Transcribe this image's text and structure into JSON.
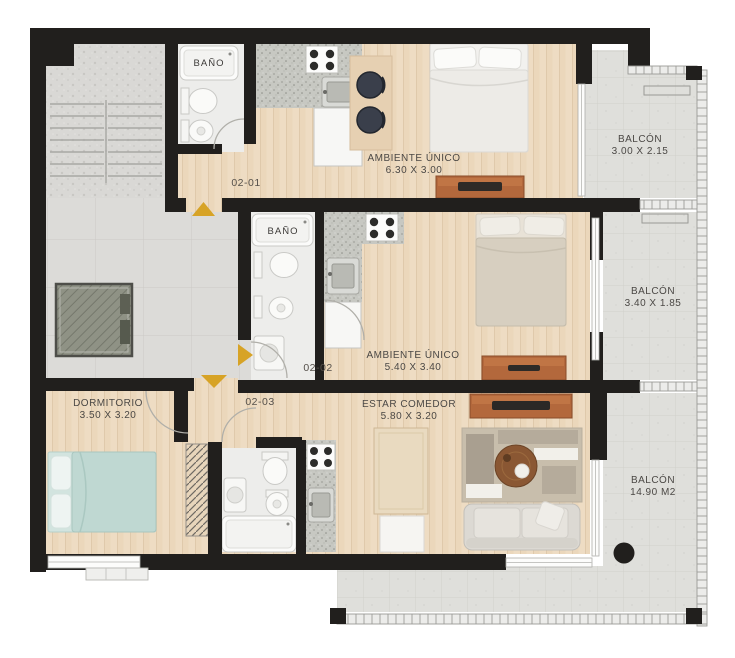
{
  "plan": {
    "type": "apartment-floor-plan",
    "units": {
      "unit_1": {
        "code": "02-01"
      },
      "unit_2": {
        "code": "02-02"
      },
      "unit_3": {
        "code": "02-03"
      }
    },
    "rooms": {
      "bano_1": {
        "name": "BAÑO"
      },
      "bano_2": {
        "name": "BAÑO"
      },
      "ambiente_unico_1": {
        "name": "AMBIENTE ÚNICO",
        "dims": "6.30 X 3.00"
      },
      "ambiente_unico_2": {
        "name": "AMBIENTE ÚNICO",
        "dims": "5.40 X 3.40"
      },
      "dormitorio": {
        "name": "DORMITORIO",
        "dims": "3.50 X 3.20"
      },
      "estar_comedor": {
        "name": "ESTAR COMEDOR",
        "dims": "5.80 X 3.20"
      },
      "balcon_1": {
        "name": "BALCÓN",
        "dims": "3.00 X 2.15"
      },
      "balcon_2": {
        "name": "BALCÓN",
        "dims": "3.40 X 1.85"
      },
      "balcon_3": {
        "name": "BALCÓN",
        "dims": "14.90 M2"
      }
    },
    "colors": {
      "wall": "#211f1d",
      "entry_arrow": "#d7a326",
      "wood_floor": "#eedcc3",
      "balcony_floor": "#dfdfdb",
      "hall_floor": "#dcdbd8",
      "dresser": "#b3683c",
      "bed_teal": "#bfd8d2"
    }
  }
}
